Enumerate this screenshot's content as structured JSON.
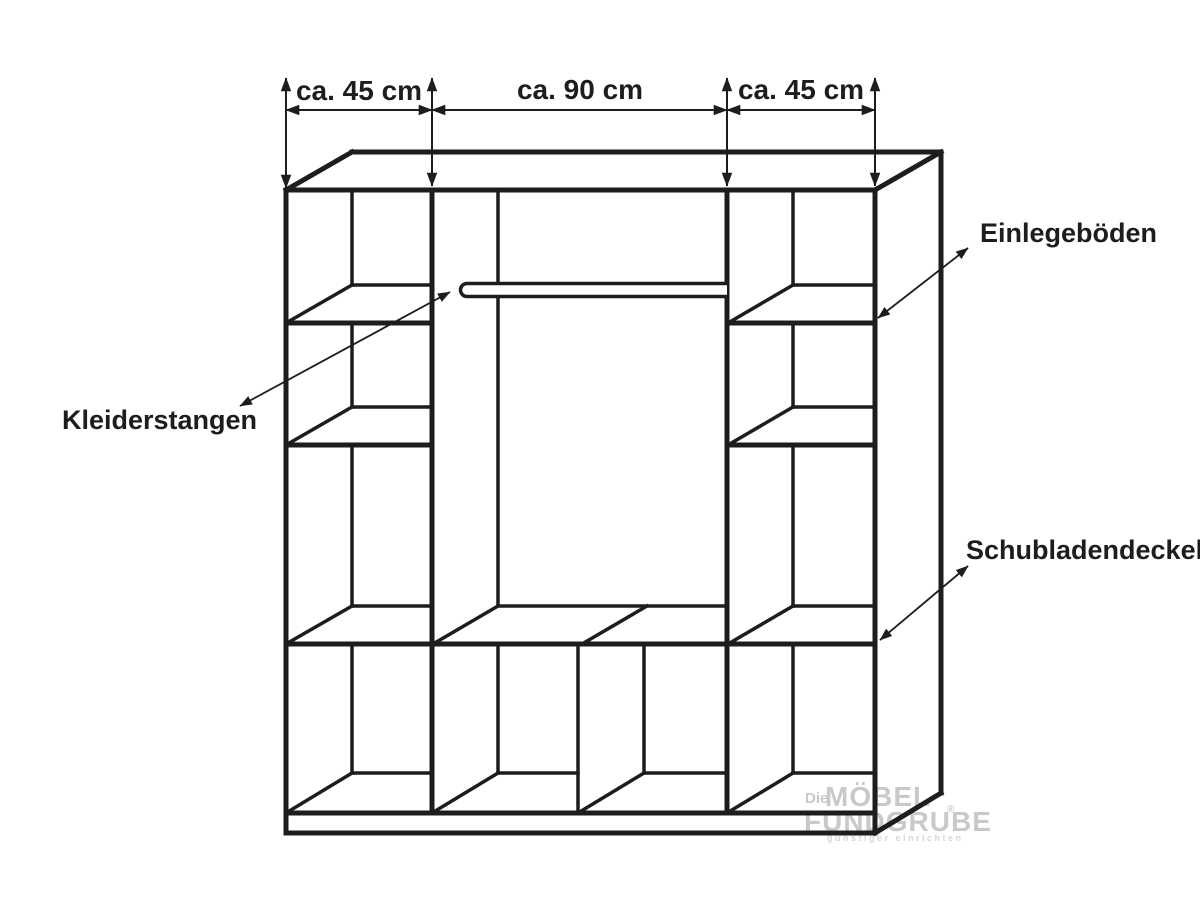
{
  "diagram": {
    "type": "furniture-dimension-drawing",
    "subject": "wardrobe interior line drawing (axonometric view)",
    "background": "#ffffff",
    "line_color": "#1d1d1b",
    "dimensions": {
      "left": "ca. 45 cm",
      "middle": "ca. 90 cm",
      "right": "ca. 45 cm"
    },
    "callouts": {
      "clothes_rails": "Kleiderstangen",
      "shelves": "Einlegeböden",
      "drawer_covers": "Schubladendeckel"
    },
    "watermark": {
      "prefix": "Die",
      "line1": "MÖBEL",
      "line2": "FUNDGRUBE",
      "registered": "®",
      "tagline": "günstiger einrichten",
      "color": "#c9c9c9"
    }
  }
}
